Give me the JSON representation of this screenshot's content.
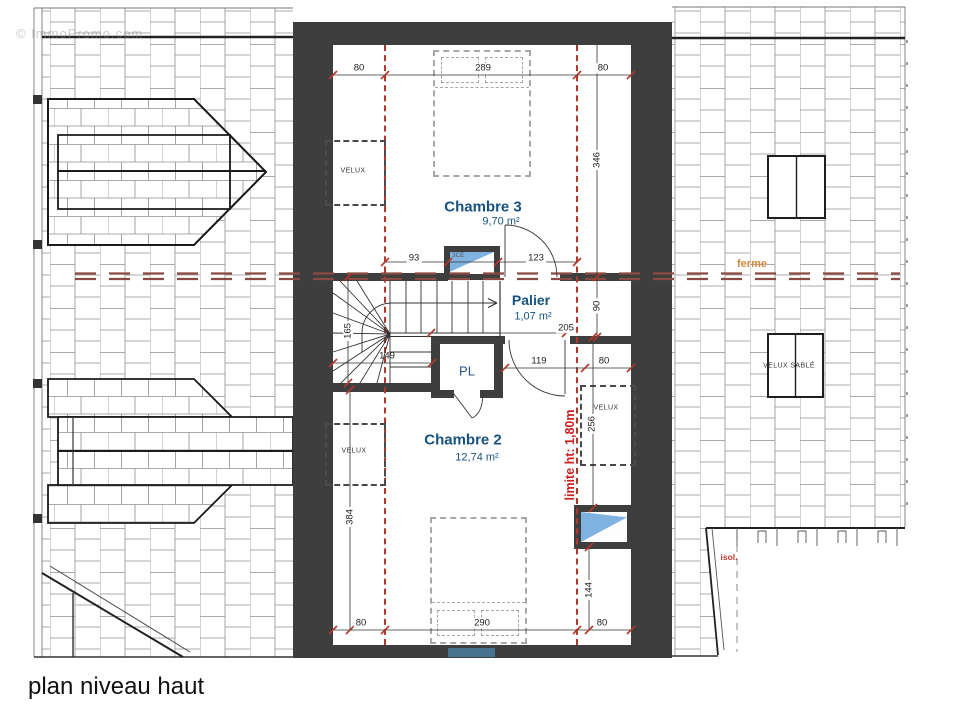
{
  "watermark": "© ImmoPromo.com",
  "title": "plan niveau haut",
  "rooms": {
    "chambre3": {
      "name": "Chambre 3",
      "area": "9,70 m²"
    },
    "palier": {
      "name": "Palier",
      "area": "1,07 m²"
    },
    "pl": {
      "name": "PL"
    },
    "chambre2": {
      "name": "Chambre 2",
      "area": "12,74 m²"
    }
  },
  "annotations": {
    "velux": "VELUX",
    "velux_sable": "VELUX SABLÉ",
    "ferme": "ferme",
    "limite": "limite ht: 1,80m",
    "isol": "isol.",
    "window_ref": "3CE"
  },
  "dimensions": {
    "c3_top_left": "80",
    "c3_top_mid": "289",
    "c3_top_right": "80",
    "c3_height": "346",
    "c3_bot_left": "93",
    "c3_bot_right": "123",
    "palier_height": "90",
    "palier_width": "205",
    "stair_left": "165",
    "stair_width": "149",
    "pl_right": "119",
    "velux_right": "80",
    "velux_height": "256",
    "c2_height": "384",
    "window_height": "144",
    "c2_bot_left": "80",
    "c2_bot_mid": "290",
    "c2_bot_right": "80"
  },
  "colors": {
    "wall": "#3e3e3e",
    "dashed_red": "#b3372b",
    "ferme_line": "#8a4a42",
    "ferme_label": "#d0883c",
    "room_label": "#17527f",
    "limit_text": "#cc2020",
    "window_blue": "#7fb2e0"
  }
}
